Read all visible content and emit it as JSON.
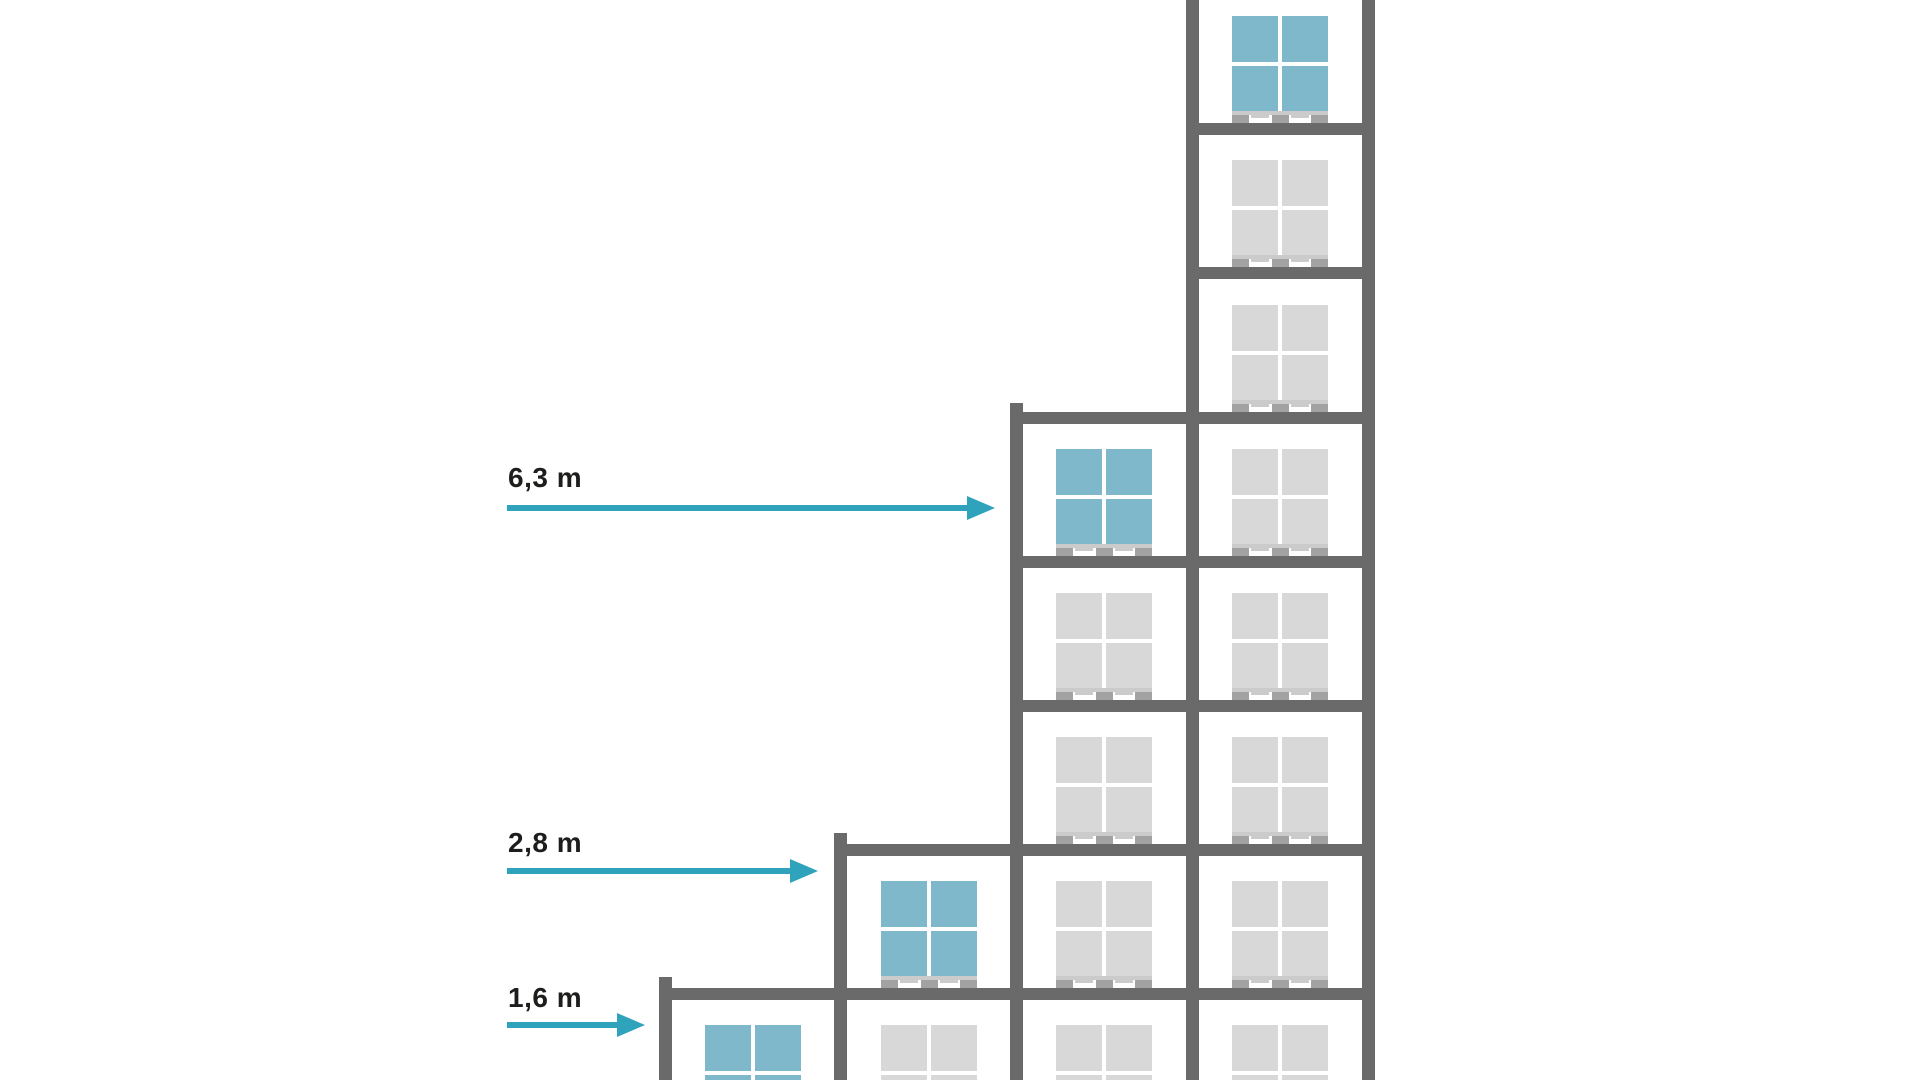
{
  "diagram": {
    "rack_heights_m": [
      6.3,
      2.8,
      1.6
    ],
    "labels": [
      {
        "text": "6,3 m",
        "x": 508,
        "y": 464,
        "arrow": {
          "x1": 507,
          "x2": 995,
          "y": 508
        }
      },
      {
        "text": "2,8 m",
        "x": 508,
        "y": 829,
        "arrow": {
          "x1": 507,
          "x2": 818,
          "y": 871
        }
      },
      {
        "text": "1,6 m",
        "x": 508,
        "y": 984,
        "arrow": {
          "x1": 507,
          "x2": 645,
          "y": 1025
        }
      }
    ],
    "colors": {
      "structure": "#6a6a6a",
      "box_gray": "#d8d8d8",
      "box_teal": "#7fb8cb",
      "divider": "#ffffff",
      "pallet_deck": "#cbcbcb",
      "pallet_foot": "#a2a2a2",
      "arrow": "#2fa3bb",
      "label": "#1d1d1b",
      "background": "#ffffff"
    },
    "dimensions": {
      "stage_width": 1920,
      "stage_height": 1080,
      "post_width": 13,
      "beam_height": 12,
      "box_width": 96,
      "box_height": 95,
      "pallet_height": 12
    },
    "posts": [
      {
        "x": 659,
        "top": 977
      },
      {
        "x": 834,
        "top": 833
      },
      {
        "x": 1010,
        "top": 403
      },
      {
        "x": 1186,
        "top": -30
      },
      {
        "x": 1362,
        "top": -30
      }
    ],
    "beams": [
      {
        "x1": 1186,
        "x2": 1375,
        "y": 123
      },
      {
        "x1": 1186,
        "x2": 1375,
        "y": 267
      },
      {
        "x1": 1010,
        "x2": 1375,
        "y": 412
      },
      {
        "x1": 1010,
        "x2": 1375,
        "y": 556
      },
      {
        "x1": 1010,
        "x2": 1375,
        "y": 700
      },
      {
        "x1": 834,
        "x2": 1375,
        "y": 844
      },
      {
        "x1": 659,
        "x2": 1375,
        "y": 988
      }
    ],
    "loads": [
      {
        "cx": 1280,
        "top": 16,
        "highlight": true
      },
      {
        "cx": 1280,
        "top": 160,
        "highlight": false
      },
      {
        "cx": 1280,
        "top": 305,
        "highlight": false
      },
      {
        "cx": 1280,
        "top": 449,
        "highlight": false
      },
      {
        "cx": 1280,
        "top": 593,
        "highlight": false
      },
      {
        "cx": 1280,
        "top": 737,
        "highlight": false
      },
      {
        "cx": 1280,
        "top": 881,
        "highlight": false
      },
      {
        "cx": 1280,
        "top": 1025,
        "highlight": false
      },
      {
        "cx": 1104,
        "top": 449,
        "highlight": true
      },
      {
        "cx": 1104,
        "top": 593,
        "highlight": false
      },
      {
        "cx": 1104,
        "top": 737,
        "highlight": false
      },
      {
        "cx": 1104,
        "top": 881,
        "highlight": false
      },
      {
        "cx": 1104,
        "top": 1025,
        "highlight": false
      },
      {
        "cx": 929,
        "top": 881,
        "highlight": true
      },
      {
        "cx": 929,
        "top": 1025,
        "highlight": false
      },
      {
        "cx": 753,
        "top": 1025,
        "highlight": true
      }
    ]
  }
}
